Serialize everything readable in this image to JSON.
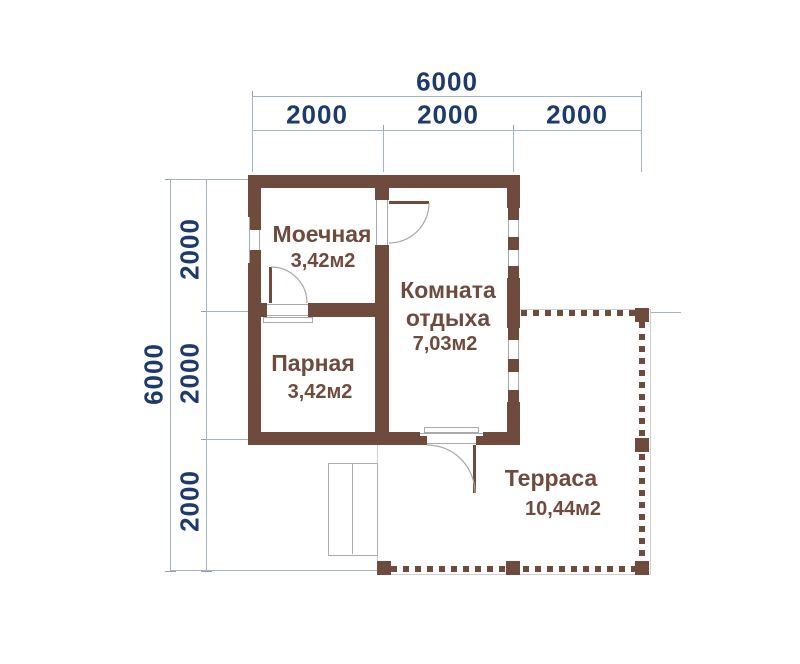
{
  "dimensions": {
    "top": {
      "total": "6000",
      "segments": [
        "2000",
        "2000",
        "2000"
      ]
    },
    "left": {
      "total": "6000",
      "segments": [
        "2000",
        "2000",
        "2000"
      ]
    }
  },
  "rooms": {
    "washroom": {
      "name": "Моечная",
      "area": "3,42м2"
    },
    "steam_room": {
      "name": "Парная",
      "area": "3,42м2"
    },
    "rest_room": {
      "name": "Комната отдыха",
      "area": "7,03м2"
    },
    "terrace": {
      "name": "Терраса",
      "area": "10,44м2"
    }
  },
  "colors": {
    "wall": "#6F4B3D",
    "room_text": "#6F4B3D",
    "dimension_text": "#1D3A6B",
    "dimension_line": "#A6B2C6",
    "door_arc": "#A9A9A9",
    "terrace_outline": "#CFCFCF"
  }
}
